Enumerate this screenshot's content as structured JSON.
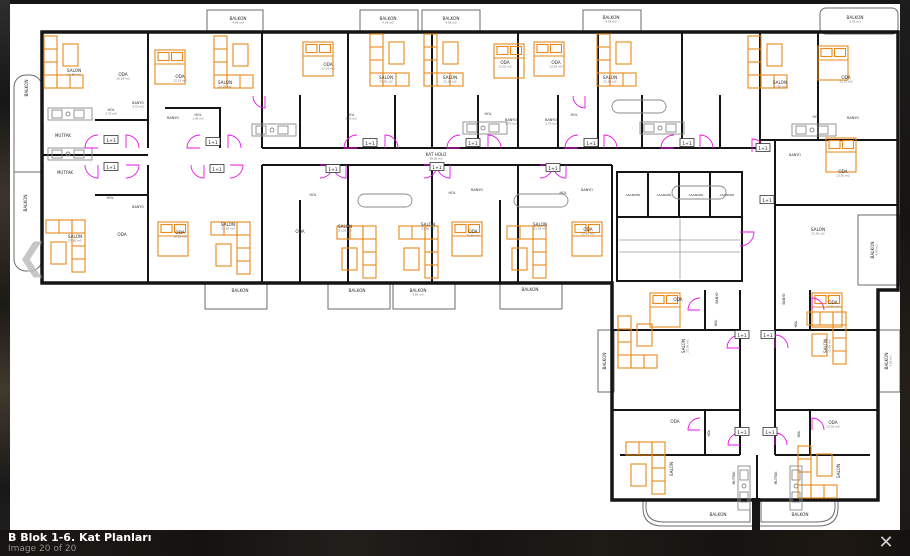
{
  "lightbox": {
    "caption_title": "B Blok 1-6. Kat Planları",
    "caption_counter": "Image 20 of 20",
    "close_icon": "✕",
    "prev_icon": "❮"
  },
  "colors": {
    "wall": "#151515",
    "furniture": "#e8891a",
    "door": "#e714e7",
    "balcony": "#6b6b6b",
    "fixture": "#8a8a8a",
    "label": "#2e2e2e",
    "area_label": "#6a6a6a"
  },
  "plan": {
    "badge_text": "1+1",
    "labels": [
      {
        "t": "SALON",
        "a": "27.85 m2",
        "x": 74,
        "y": 72
      },
      {
        "t": "ODA",
        "a": "16.28 m2",
        "x": 123,
        "y": 76
      },
      {
        "t": "BANYO",
        "a": "3.70 m2",
        "x": 138,
        "y": 104,
        "s": 3.4
      },
      {
        "t": "HOL",
        "a": "2.70 m2",
        "x": 111,
        "y": 111,
        "s": 3.4
      },
      {
        "t": "MUTFAK",
        "x": 63,
        "y": 137,
        "s": 4
      },
      {
        "t": "ODA",
        "a": "12.25 m2",
        "x": 180,
        "y": 78
      },
      {
        "t": "SALON",
        "a": "21.05 m2",
        "x": 225,
        "y": 84
      },
      {
        "t": "BANYO",
        "x": 173,
        "y": 119,
        "s": 3.4
      },
      {
        "t": "HOL",
        "a": "1.90 m2",
        "x": 198,
        "y": 116,
        "s": 3.4
      },
      {
        "t": "ODA",
        "a": "12.25 m2",
        "x": 328,
        "y": 66
      },
      {
        "t": "SALON",
        "a": "21.05 m2",
        "x": 386,
        "y": 79
      },
      {
        "t": "SALON",
        "a": "21.05 m2",
        "x": 450,
        "y": 79
      },
      {
        "t": "HOL",
        "a": "1.90 m2",
        "x": 351,
        "y": 116,
        "s": 3.4
      },
      {
        "t": "ODA",
        "a": "12.25 m2",
        "x": 505,
        "y": 64
      },
      {
        "t": "ODA",
        "a": "12.25 m2",
        "x": 556,
        "y": 64
      },
      {
        "t": "BANYO",
        "a": "3.70 m2",
        "x": 511,
        "y": 121,
        "s": 3.4
      },
      {
        "t": "BANYO",
        "a": "3.70 m2",
        "x": 551,
        "y": 121,
        "s": 3.4
      },
      {
        "t": "HOL",
        "x": 488,
        "y": 115,
        "s": 3.4
      },
      {
        "t": "HOL",
        "x": 574,
        "y": 116,
        "s": 3.4
      },
      {
        "t": "SALON",
        "a": "21.05 m2",
        "x": 610,
        "y": 79
      },
      {
        "t": "SALON",
        "a": "27.85 m2",
        "x": 780,
        "y": 84
      },
      {
        "t": "ODA",
        "a": "11.75 m2",
        "x": 846,
        "y": 79
      },
      {
        "t": "HOL",
        "x": 816,
        "y": 118,
        "s": 3.4
      },
      {
        "t": "BANYO",
        "x": 853,
        "y": 119,
        "s": 3.4
      },
      {
        "t": "BANYO",
        "x": 795,
        "y": 156,
        "s": 3.4
      },
      {
        "t": "ODA",
        "a": "12.50 m2",
        "x": 843,
        "y": 173
      },
      {
        "t": "KAT HOLÜ",
        "a": "38.08 m2",
        "x": 436,
        "y": 156
      },
      {
        "t": "MUTFAK",
        "x": 65,
        "y": 174,
        "s": 4
      },
      {
        "t": "HOL",
        "x": 110,
        "y": 199,
        "s": 3.4
      },
      {
        "t": "BANYO",
        "x": 138,
        "y": 208,
        "s": 3.4
      },
      {
        "t": "SALON",
        "a": "27.85 m2",
        "x": 75,
        "y": 238
      },
      {
        "t": "ODA",
        "x": 122,
        "y": 236
      },
      {
        "t": "ODA",
        "a": "12.25 m2",
        "x": 180,
        "y": 234
      },
      {
        "t": "SALON",
        "a": "21.05 m2",
        "x": 228,
        "y": 226
      },
      {
        "t": "ODA",
        "x": 300,
        "y": 233
      },
      {
        "t": "HOL",
        "x": 313,
        "y": 196,
        "s": 3.4
      },
      {
        "t": "HOL",
        "x": 452,
        "y": 194,
        "s": 3.4
      },
      {
        "t": "HOL",
        "x": 563,
        "y": 194,
        "s": 3.4
      },
      {
        "t": "BANYO",
        "x": 477,
        "y": 191,
        "s": 3.4
      },
      {
        "t": "BANYO",
        "x": 587,
        "y": 191,
        "s": 3.4
      },
      {
        "t": "SALON",
        "a": "21.05 m2",
        "x": 345,
        "y": 228
      },
      {
        "t": "SALON",
        "a": "21.05 m2",
        "x": 428,
        "y": 226
      },
      {
        "t": "SALON",
        "a": "21.05 m2",
        "x": 540,
        "y": 226
      },
      {
        "t": "ODA",
        "a": "12.50 m2",
        "x": 473,
        "y": 233
      },
      {
        "t": "ODA",
        "a": "12.50 m2",
        "x": 588,
        "y": 231
      },
      {
        "t": "ASANSÖR",
        "x": 633,
        "y": 196,
        "s": 3
      },
      {
        "t": "ASANSÖR",
        "x": 664,
        "y": 196,
        "s": 3
      },
      {
        "t": "ASANSÖR",
        "x": 696,
        "y": 196,
        "s": 3
      },
      {
        "t": "ASANSÖR",
        "x": 727,
        "y": 196,
        "s": 3
      },
      {
        "t": "SALON",
        "a": "21.05 m2",
        "x": 818,
        "y": 231
      },
      {
        "t": "ODA",
        "x": 678,
        "y": 301
      },
      {
        "t": "ODA",
        "a": "12.50 m2",
        "x": 833,
        "y": 304
      },
      {
        "t": "BANYO",
        "x": 718,
        "y": 298,
        "r": -90,
        "s": 3.2
      },
      {
        "t": "BANYO",
        "x": 785,
        "y": 299,
        "r": -90,
        "s": 3.2
      },
      {
        "t": "HOL",
        "x": 717,
        "y": 323,
        "r": -90,
        "s": 3.2
      },
      {
        "t": "HOL",
        "x": 797,
        "y": 324,
        "r": -90,
        "s": 3.2
      },
      {
        "t": "SALON",
        "a": "21.05 m2",
        "x": 685,
        "y": 346,
        "r": -90
      },
      {
        "t": "SALON",
        "a": "21.05 m2",
        "x": 827,
        "y": 346,
        "r": -90
      },
      {
        "t": "ODA",
        "x": 675,
        "y": 423
      },
      {
        "t": "ODA",
        "a": "12.50 m2",
        "x": 833,
        "y": 424
      },
      {
        "t": "HOL",
        "x": 710,
        "y": 433,
        "r": -90,
        "s": 3.2
      },
      {
        "t": "HOL",
        "x": 800,
        "y": 434,
        "r": -90,
        "s": 3.2
      },
      {
        "t": "SALON",
        "x": 673,
        "y": 469,
        "r": -90
      },
      {
        "t": "SALON",
        "x": 840,
        "y": 471,
        "r": -90
      },
      {
        "t": "MUTFAK",
        "x": 735,
        "y": 478,
        "r": -90,
        "s": 3.2
      },
      {
        "t": "MUTFAK",
        "x": 777,
        "y": 478,
        "r": -90,
        "s": 3.2
      },
      {
        "t": "BALKON",
        "a": "4.56 m2",
        "x": 238,
        "y": 20
      },
      {
        "t": "BALKON",
        "a": "4.56 m2",
        "x": 388,
        "y": 20
      },
      {
        "t": "BALKON",
        "a": "4.56 m2",
        "x": 451,
        "y": 20
      },
      {
        "t": "BALKON",
        "a": "4.56 m2",
        "x": 611,
        "y": 19
      },
      {
        "t": "BALKON",
        "a": "5.05 m2",
        "x": 855,
        "y": 19
      },
      {
        "t": "BALKON",
        "x": 28,
        "y": 88,
        "r": -90
      },
      {
        "t": "BALKON",
        "x": 27,
        "y": 203,
        "r": -90
      },
      {
        "t": "BALKON",
        "x": 240,
        "y": 292
      },
      {
        "t": "BALKON",
        "x": 357,
        "y": 292
      },
      {
        "t": "BALKON",
        "a": "3.05 m2",
        "x": 418,
        "y": 292
      },
      {
        "t": "BALKON",
        "x": 530,
        "y": 291
      },
      {
        "t": "BALKON",
        "a": "4.56 m2",
        "x": 874,
        "y": 250,
        "r": -90
      },
      {
        "t": "BALKON",
        "x": 606,
        "y": 361,
        "r": -90
      },
      {
        "t": "BALKON",
        "a": "3.05 m2",
        "x": 888,
        "y": 361,
        "r": -90
      },
      {
        "t": "BALKON",
        "x": 718,
        "y": 516
      },
      {
        "t": "BALKON",
        "x": 800,
        "y": 516
      }
    ],
    "badges": [
      {
        "x": 111,
        "y": 140
      },
      {
        "x": 213,
        "y": 142
      },
      {
        "x": 370,
        "y": 143
      },
      {
        "x": 473,
        "y": 143
      },
      {
        "x": 591,
        "y": 143
      },
      {
        "x": 687,
        "y": 143
      },
      {
        "x": 763,
        "y": 148
      },
      {
        "x": 111,
        "y": 167
      },
      {
        "x": 217,
        "y": 169
      },
      {
        "x": 333,
        "y": 169
      },
      {
        "x": 437,
        "y": 167
      },
      {
        "x": 553,
        "y": 168
      },
      {
        "x": 767,
        "y": 200
      },
      {
        "x": 742,
        "y": 335
      },
      {
        "x": 768,
        "y": 335
      },
      {
        "x": 742,
        "y": 432
      },
      {
        "x": 770,
        "y": 432
      }
    ],
    "furniture": [
      {
        "k": "sofa",
        "x": 44,
        "y": 36
      },
      {
        "k": "sofa",
        "x": 214,
        "y": 36
      },
      {
        "k": "sofa",
        "x": 370,
        "y": 34
      },
      {
        "k": "sofa",
        "x": 424,
        "y": 34
      },
      {
        "k": "sofa",
        "x": 597,
        "y": 34
      },
      {
        "k": "sofa",
        "x": 748,
        "y": 36
      },
      {
        "k": "sofa",
        "x": 45,
        "y": 224,
        "r": 180
      },
      {
        "k": "sofa",
        "x": 210,
        "y": 226,
        "r": 180
      },
      {
        "k": "sofa",
        "x": 336,
        "y": 230,
        "r": 180
      },
      {
        "k": "sofa",
        "x": 398,
        "y": 230,
        "r": 180
      },
      {
        "k": "sofa",
        "x": 506,
        "y": 230,
        "r": 180
      },
      {
        "k": "sofa",
        "x": 618,
        "y": 316
      },
      {
        "k": "sofa",
        "x": 806,
        "y": 316,
        "r": 180
      },
      {
        "k": "sofa",
        "x": 625,
        "y": 446,
        "r": 180
      },
      {
        "k": "sofa",
        "x": 798,
        "y": 446
      },
      {
        "k": "bed",
        "x": 155,
        "y": 50
      },
      {
        "k": "bed",
        "x": 303,
        "y": 42
      },
      {
        "k": "bed",
        "x": 494,
        "y": 44
      },
      {
        "k": "bed",
        "x": 534,
        "y": 42
      },
      {
        "k": "bed",
        "x": 818,
        "y": 46
      },
      {
        "k": "bed",
        "x": 826,
        "y": 138
      },
      {
        "k": "bed",
        "x": 158,
        "y": 222
      },
      {
        "k": "bed",
        "x": 452,
        "y": 222
      },
      {
        "k": "bed",
        "x": 572,
        "y": 222
      },
      {
        "k": "bed",
        "x": 650,
        "y": 293
      },
      {
        "k": "bed",
        "x": 812,
        "y": 293
      },
      {
        "k": "counter",
        "x": 48,
        "y": 108
      },
      {
        "k": "counter",
        "x": 48,
        "y": 148
      },
      {
        "k": "counter",
        "x": 252,
        "y": 124
      },
      {
        "k": "counter",
        "x": 463,
        "y": 122
      },
      {
        "k": "counter",
        "x": 640,
        "y": 122
      },
      {
        "k": "counter",
        "x": 792,
        "y": 124
      },
      {
        "k": "counter",
        "x": 706,
        "y": 462,
        "r": 90
      },
      {
        "k": "counter",
        "x": 758,
        "y": 462,
        "r": 90
      },
      {
        "k": "pill",
        "x": 358,
        "y": 194
      },
      {
        "k": "pill",
        "x": 514,
        "y": 194
      },
      {
        "k": "pill",
        "x": 612,
        "y": 100
      },
      {
        "k": "pill",
        "x": 672,
        "y": 186
      }
    ],
    "doors": [
      [
        98,
        148,
        13,
        180,
        270
      ],
      [
        126,
        148,
        13,
        270,
        360
      ],
      [
        200,
        148,
        13,
        180,
        270
      ],
      [
        228,
        148,
        13,
        270,
        360
      ],
      [
        357,
        148,
        13,
        180,
        270
      ],
      [
        385,
        148,
        13,
        270,
        360
      ],
      [
        460,
        148,
        13,
        180,
        270
      ],
      [
        488,
        148,
        13,
        270,
        360
      ],
      [
        578,
        148,
        13,
        180,
        270
      ],
      [
        604,
        148,
        13,
        270,
        360
      ],
      [
        674,
        148,
        13,
        180,
        270
      ],
      [
        700,
        148,
        13,
        270,
        360
      ],
      [
        752,
        152,
        13,
        270,
        360
      ],
      [
        98,
        165,
        13,
        90,
        180
      ],
      [
        126,
        165,
        13,
        0,
        90
      ],
      [
        204,
        165,
        13,
        90,
        180
      ],
      [
        230,
        165,
        13,
        0,
        90
      ],
      [
        320,
        165,
        13,
        0,
        90
      ],
      [
        346,
        165,
        13,
        90,
        180
      ],
      [
        424,
        165,
        13,
        0,
        90
      ],
      [
        450,
        165,
        13,
        90,
        180
      ],
      [
        540,
        165,
        13,
        0,
        90
      ],
      [
        566,
        165,
        13,
        90,
        180
      ],
      [
        265,
        96,
        12,
        90,
        180
      ],
      [
        585,
        96,
        12,
        90,
        180
      ],
      [
        740,
        232,
        14,
        0,
        90
      ],
      [
        740,
        348,
        13,
        180,
        270
      ],
      [
        775,
        348,
        13,
        270,
        360
      ],
      [
        740,
        445,
        12,
        180,
        270
      ],
      [
        775,
        445,
        12,
        270,
        360
      ],
      [
        700,
        310,
        12,
        180,
        270
      ],
      [
        812,
        310,
        12,
        270,
        360
      ],
      [
        700,
        430,
        12,
        180,
        270
      ],
      [
        812,
        430,
        12,
        270,
        360
      ]
    ]
  }
}
